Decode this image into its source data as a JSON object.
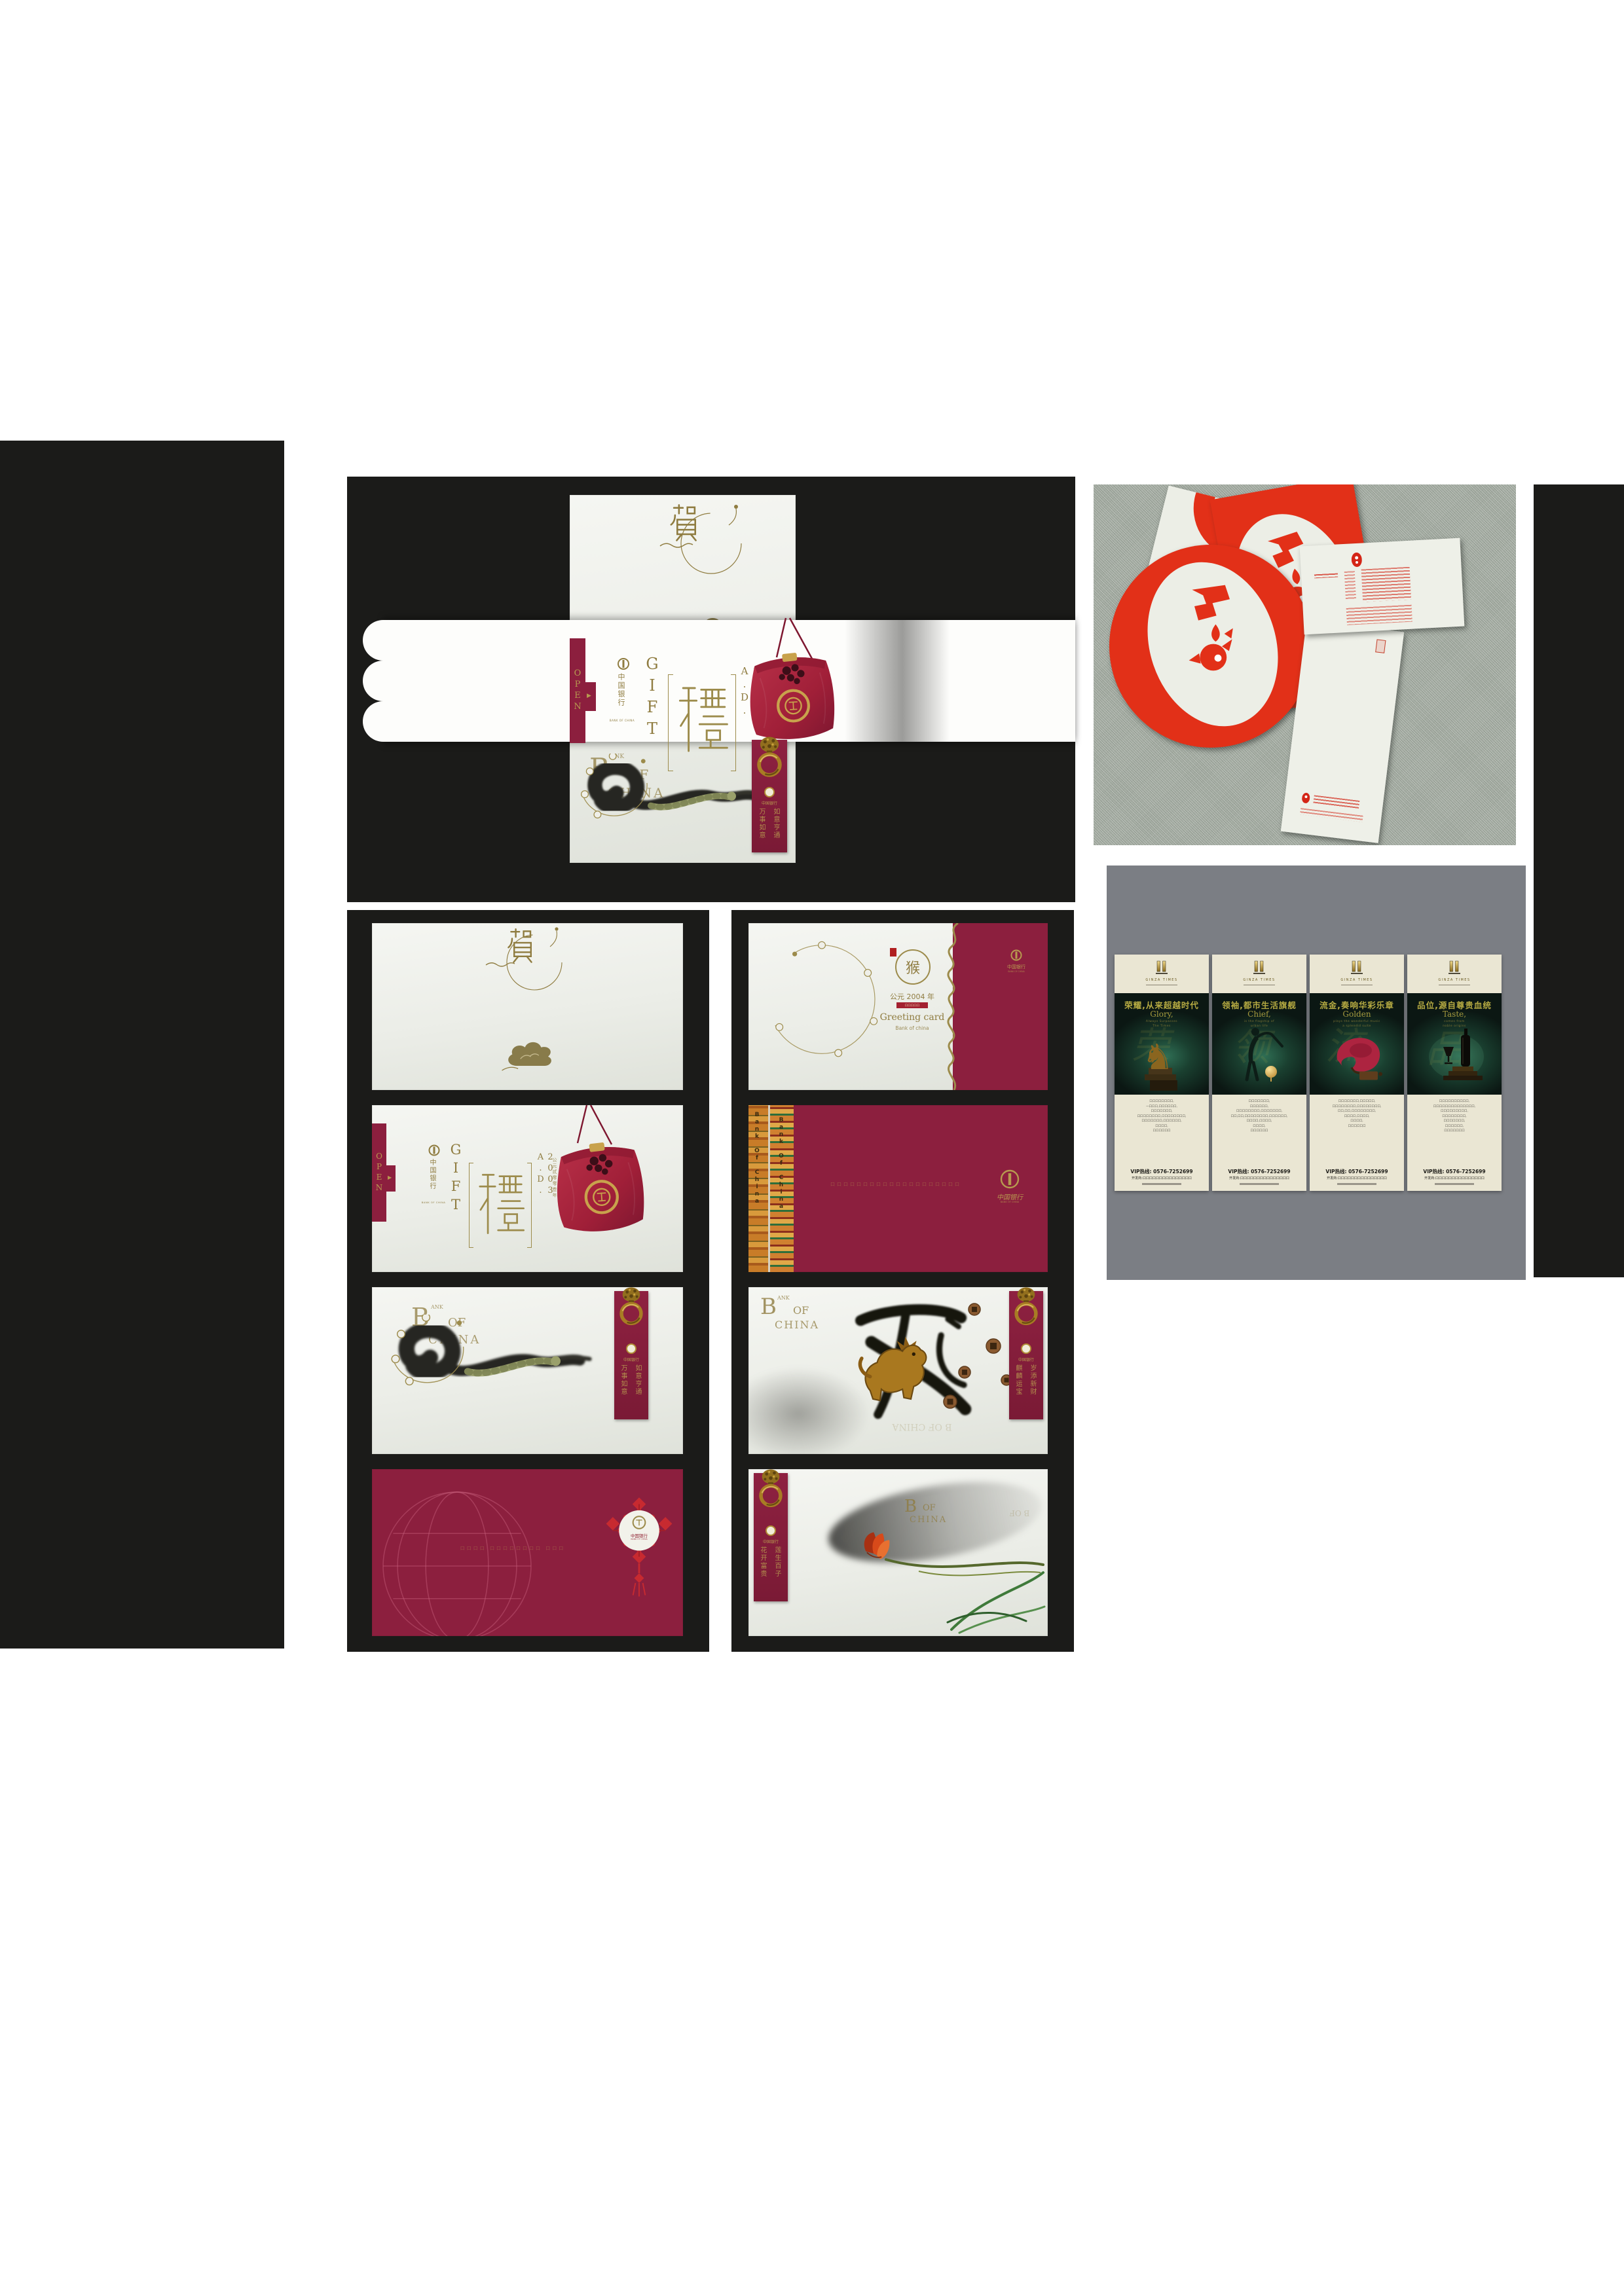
{
  "colors": {
    "panel_black": "#1b1b19",
    "card_white": "#eef0ea",
    "maroon": "#8c1f3e",
    "gold": "#8f7c40",
    "gold_bright": "#c8a24c",
    "pouch_red": "#b12a42",
    "photo_red": "#e23018",
    "carpet_gray_green": "#a9b1a7",
    "poster_panel_gray": "#7b7e84",
    "poster_cream": "#eae6d3",
    "poster_dark_teal": "#0b1713",
    "headline_gold": "#b5aa42",
    "ink_black": "#262521"
  },
  "top_card": {
    "he": "賀",
    "open": "OPEN",
    "open_arrow": "▶",
    "logo_cn": "中国银行",
    "logo_en": "BANK OF CHINA",
    "gift": "GIFT",
    "li": "禮",
    "year_en": "2003 A.D.",
    "year_cn": "公元贰零零叁年",
    "wm_b": "B",
    "wm_ank": "ANK",
    "wm_of": "OF",
    "wm_china": "CHINA",
    "strip_right": "如意亨通",
    "strip_left": "万事如意",
    "strip_logo": "中国银行"
  },
  "mid_left": {
    "cards": [
      {
        "he": "賀"
      },
      {
        "open": "OPEN",
        "open_arrow": "▶",
        "logo_cn": "中国银行",
        "logo_en": "BANK OF CHINA",
        "gift": "GIFT",
        "li": "禮",
        "year_en": "2003 A.D.",
        "year_cn": "公元贰零零叁年"
      },
      {
        "wm_b": "B",
        "wm_ank": "ANK",
        "wm_of": "OF",
        "wm_china": "CHINA",
        "strip_right": "如意亨通",
        "strip_left": "万事如意",
        "strip_logo": "中国银行"
      },
      {
        "micro": "口口口口 口口口口口口口口 口口口",
        "medallion_cn": "中国银行",
        "medallion_en": "BANK OF CHINA"
      }
    ]
  },
  "mid_right": {
    "cards": [
      {
        "zodiac": "猴",
        "year": "公元 2004 年",
        "seal": "口口口口口",
        "greeting": "Greeting card",
        "bank": "Bank of china",
        "logo_cn": "中国银行",
        "logo_en": "BANK OF CHINA"
      },
      {
        "strip_text": "Bank Of China",
        "strip_text2": "Bank Of China",
        "micro": "口口口口口口口口口口口口口口口口口口口口",
        "logo_cn": "中国银行",
        "logo_en": "BANK OF CHINA"
      },
      {
        "wm_b": "B",
        "wm_ank": "ANK",
        "wm_of": "OF",
        "wm_china": "CHINA",
        "strip_right": "岁添新财",
        "strip_left": "麒麟运宝",
        "strip_logo": "中国银行",
        "wm_mirror": "B OF CHINA"
      },
      {
        "strip_right": "莲生百子",
        "strip_left": "花开富贵",
        "strip_logo": "中国银行",
        "wm_b": "B",
        "wm_of": "OF",
        "wm_china": "CHINA",
        "wm_mirror": "B OF"
      }
    ]
  },
  "posters": {
    "brand": "GINZA TIMES",
    "items": [
      {
        "headline": "荣耀,从来超越时代",
        "en": "Glory,",
        "sub1": "Always Surpasses",
        "sub2": "The Times",
        "ghost": "荣",
        "body": [
          "口口口口口口口口,",
          "一口口口,口口口口口口,",
          "口口口口口口口,",
          "口口口口口口口口,口口口口口口口口,",
          "口口口口口口口,口口口口口口,",
          "口口口口,",
          "口口口口口口"
        ],
        "vip": "VIP热线: 0576-7252699",
        "dev": "开发商:口口口口口口口口口口口口口口口"
      },
      {
        "headline": "领袖,都市生活旗舰",
        "en": "Chief,",
        "sub1": "is the flagship of",
        "sub2": "urban life",
        "ghost": "领",
        "body": [
          "口口口口口口口,",
          "口口口口口口,",
          "口口口口口口口口,口口口口口口口,",
          "口口,口口,口口口口口口口口,口口口口口口,",
          "口口口口,口口口口,",
          "口口口口,",
          "口口口口口口"
        ],
        "vip": "VIP热线: 0576-7252699",
        "dev": "开发商:口口口口口口口口口口口口口口口"
      },
      {
        "headline": "流金,奏响华彩乐章",
        "en": "Golden",
        "sub1": "plays the wonderful music",
        "sub2": "a splendid suite",
        "ghost": "流",
        "body": [
          "口口口口口口口,口口口口口,",
          "口口口口口口口口,口口口口口口口口,",
          "口口,口口,口口口口口口口口,",
          "口口口口,口口口口,",
          "口口口口,",
          "口口口口口口"
        ],
        "vip": "VIP热线: 0576-7252699",
        "dev": "开发商:口口口口口口口口口口口口口口口"
      },
      {
        "headline": "品位,源自尊贵血统",
        "en": "Taste,",
        "sub1": "comes from",
        "sub2": "noble origins",
        "ghost": "品",
        "body": [
          "口口口口口口口口口口,",
          "口口口口口口口口口口口口口口,",
          "口口口口口口口口口,",
          "口口口口口口口口,",
          "口口口口口口口,",
          "口口口口口口,",
          "口口口口口口口"
        ],
        "vip": "VIP热线: 0576-7252699",
        "dev": "开发商:口口口口口口口口口口口口口口口"
      }
    ]
  }
}
